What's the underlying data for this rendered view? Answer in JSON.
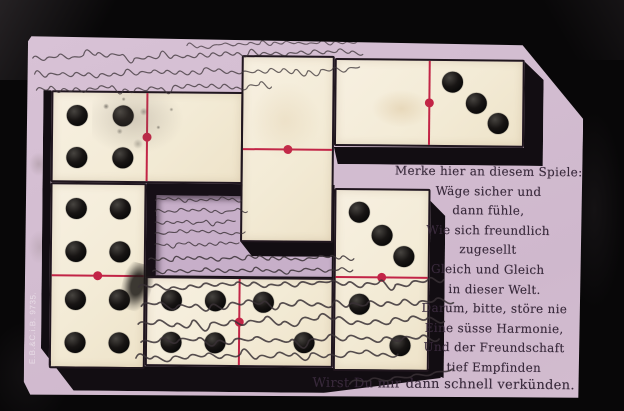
{
  "postcard": {
    "publisher_imprint": "E.B.&C.i.B. 9735.",
    "poem_lines": [
      "Merke hier an diesem Spiele:",
      "Wäge sicher und",
      "dann fühle,",
      "Wie sich freundlich",
      "zugesellt",
      "Gleich und Gleich",
      "in dieser Welt.",
      "Darum, bitte, störe nie",
      "Eine süsse Harmonie,",
      "Und der Freundschaft",
      "tief Empfinden",
      "Wirst Du mir dann schnell verkünden."
    ],
    "dominoes": [
      {
        "position": "top-left",
        "orientation": "horizontal",
        "pips": [
          4,
          0
        ]
      },
      {
        "position": "top-center",
        "orientation": "vertical",
        "pips": [
          0,
          0
        ]
      },
      {
        "position": "top-right",
        "orientation": "horizontal",
        "pips": [
          0,
          3
        ]
      },
      {
        "position": "middle-left",
        "orientation": "vertical",
        "pips": [
          4,
          4
        ]
      },
      {
        "position": "middle-right",
        "orientation": "vertical",
        "pips": [
          3,
          2
        ]
      },
      {
        "position": "bottom-center",
        "orientation": "horizontal",
        "pips": [
          4,
          2
        ]
      }
    ],
    "handwriting": "illegible handwritten ink, old German Kurrent script",
    "colors": {
      "background": "#080708",
      "card": "#d3bdd1",
      "recessed_gap": "#c7afc9",
      "domino_face": "#f3ebd6",
      "pip": "#0e0d0d",
      "divider_red": "#c22446",
      "poem_ink": "#38293b",
      "handwriting_ink": "#3a3136"
    }
  }
}
